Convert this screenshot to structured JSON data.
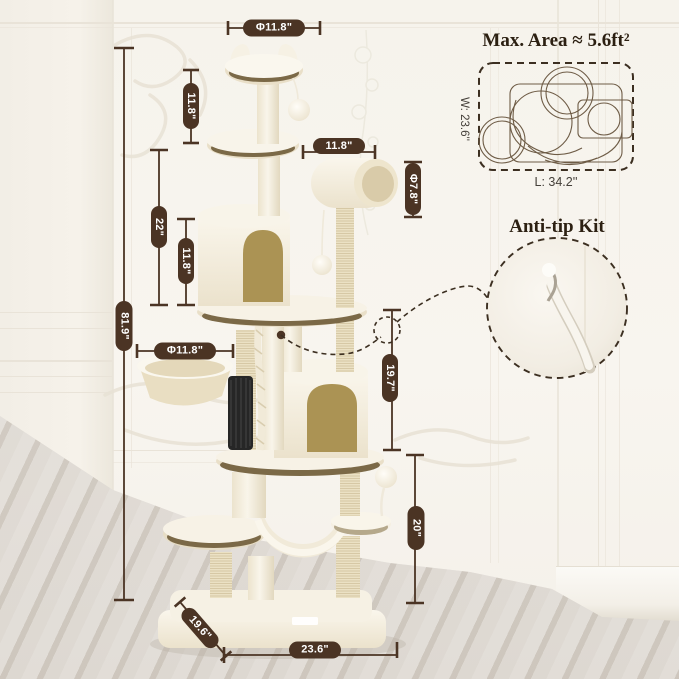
{
  "product_diagram": {
    "max_area": {
      "title": "Max. Area ≈ 5.6ft²",
      "width_label": "W: 23.6''",
      "length_label": "L: 34.2''"
    },
    "anti_tip": {
      "title": "Anti-tip Kit"
    },
    "dimensions": {
      "overall_height": "81.9\"",
      "top_section_height": "11.8\"",
      "upper_section_height": "22\"",
      "condo_height": "11.8\"",
      "top_perch_diameter": "Φ11.8\"",
      "shelf_width": "11.8\"",
      "tube_diameter": "Φ7.8\"",
      "basket_diameter": "Φ11.8\"",
      "mid_right_height": "19.7\"",
      "lower_right_height": "20\"",
      "base_depth": "19.6\"",
      "base_width": "23.6\""
    },
    "colors": {
      "dimension_brown": "#4b3424",
      "pill_text": "#ffffff",
      "heading_text": "#2c2012",
      "condo_door_tan": "#ab9354",
      "plush_cream": "#f4eee0"
    }
  }
}
